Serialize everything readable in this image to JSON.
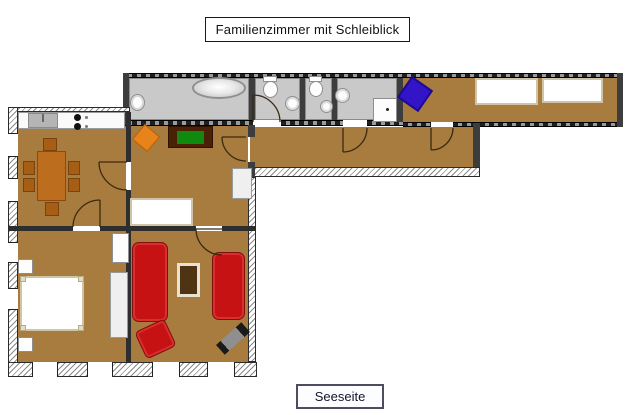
{
  "header": {
    "title": "Familienzimmer mit Schleiblick"
  },
  "footer": {
    "label": "Seeseite"
  },
  "colors": {
    "floor_brown": "#a87c3e",
    "bath_floor_gray": "#c9c9c9",
    "sofa_red": "#c61212",
    "dining_table_orange": "#bd6d1e",
    "chair_orange": "#e8821a",
    "tv_green": "#0f8a0f",
    "sideboard_dark_brown": "#4a2107",
    "object_blue": "#3414c8",
    "media_object_black": "#1a1a1a",
    "bed_white": "#ffffff"
  },
  "objects": {
    "kitchen": [
      "kitchen-counter",
      "kitchen-sink",
      "stove",
      "dining-table",
      "dining-chairs"
    ],
    "bathroom": [
      "bathtub",
      "wash-basin"
    ],
    "wc_rooms": [
      "toilet",
      "wash-basin",
      "toilet",
      "wash-basin"
    ],
    "shower_room": [
      "wash-basin",
      "shower"
    ],
    "top_bedroom": [
      "blue-chair",
      "single-bed",
      "single-bed"
    ],
    "middle_room": [
      "orange-chair",
      "tv-sideboard",
      "tv",
      "single-bed",
      "wardrobe"
    ],
    "bottom_bedroom": [
      "nightstand",
      "double-bed",
      "nightstand",
      "wardrobe",
      "cabinet"
    ],
    "living_room": [
      "sofa",
      "sofa",
      "coffee-table",
      "armchair",
      "media-object"
    ]
  }
}
